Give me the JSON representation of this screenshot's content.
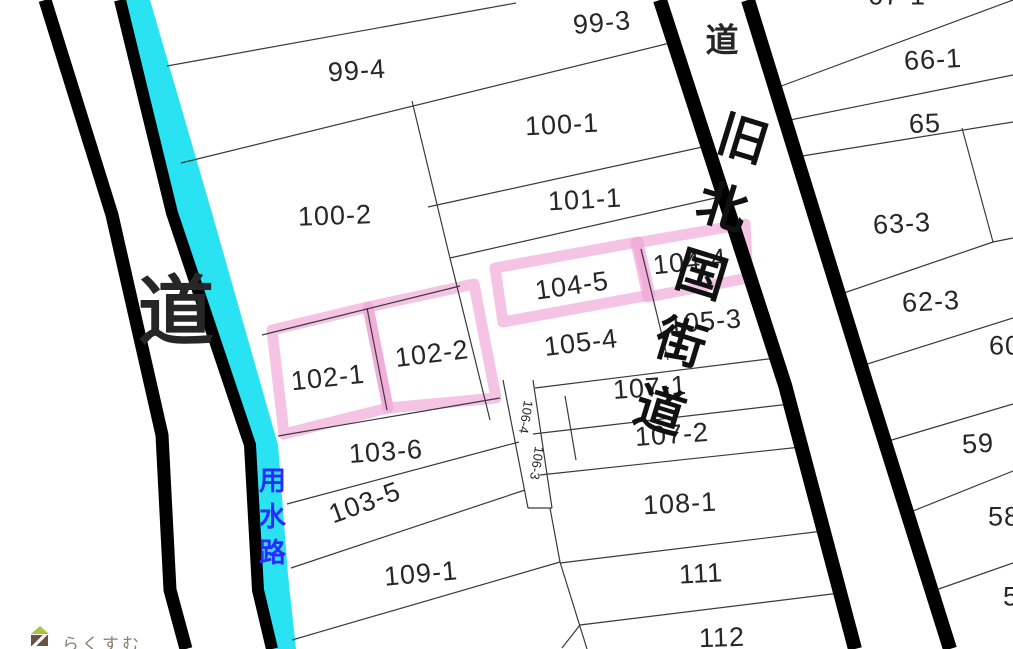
{
  "map": {
    "title": "cadastral parcel map",
    "parcels": {
      "p99_3": "99-3",
      "p99_4": "99-4",
      "p100_1": "100-1",
      "p100_2": "100-2",
      "p101_1": "101-1",
      "p102_1": "102-1",
      "p102_2": "102-2",
      "p103_5": "103-5",
      "p103_6": "103-6",
      "p104_4": "104-4",
      "p104_5": "104-5",
      "p105_3": "105-3",
      "p105_4": "105-4",
      "p106_3": "106-3",
      "p106_4": "106-4",
      "p107_1": "107-1",
      "p107_2": "107-2",
      "p108_1": "108-1",
      "p109_1": "109-1",
      "p111": "111",
      "p112": "112",
      "p67_1": "67-1",
      "p66_1": "66-1",
      "p65": "65",
      "p63_3": "63-3",
      "p62_3": "62-3",
      "p60": "60",
      "p59": "59",
      "p58": "58",
      "p5x": "5"
    },
    "roads": {
      "left_label": "道",
      "top_right_label": "道",
      "highway_label": "旧北国街道"
    },
    "waterway_label": "用水路",
    "watermark": {
      "text": "らくすむ"
    },
    "highlighted_parcels": [
      "102-1",
      "102-2",
      "104-5",
      "104-4"
    ],
    "colors": {
      "water": "#29e3f2",
      "highlight": "#ef9fd4",
      "waterway_text": "#2b2bff",
      "road": "#000000",
      "boundary": "#3a3a3a"
    }
  }
}
